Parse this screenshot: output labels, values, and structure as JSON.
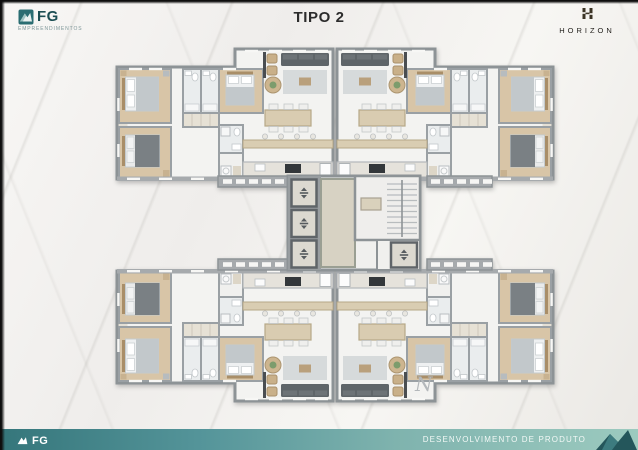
{
  "header": {
    "title": "TIPO 2",
    "fg": {
      "name": "FG",
      "tagline": "EMPREENDIMENTOS"
    },
    "horizon": {
      "name": "HORIZON"
    }
  },
  "plan": {
    "compass": "N"
  },
  "footer": {
    "fg": {
      "name": "FG",
      "tagline": "EMPREENDIMENTOS"
    },
    "caption": "DESENVOLVIMENTO DE PRODUTO"
  },
  "colors": {
    "brand_teal": "#2a6d72",
    "brand_teal_dark": "#1c4e53",
    "horizon_gold": "#3b3425",
    "footer_gradient_start": "#35767b",
    "footer_gradient_end": "#9ccabf",
    "wall_gray": "#a6aaad",
    "wood_floor": "#d8c5a7",
    "hall_beige": "#d7d2c3"
  }
}
